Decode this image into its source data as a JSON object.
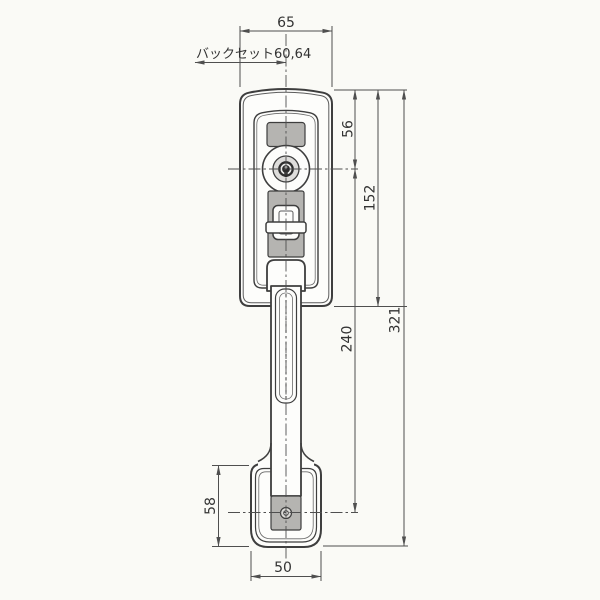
{
  "annotations": {
    "backset_label": "バックセット60,64",
    "dim_top_width": "65",
    "dim_cylinder_center": "56",
    "dim_plate_height": "152",
    "dim_handle_center_span": "240",
    "dim_overall_height": "321",
    "dim_bottom_plate_height": "58",
    "dim_bottom_plate_width": "50"
  },
  "colors": {
    "background": "#fafaf6",
    "paper": "#fdfdfb",
    "line": "#3e3e3e",
    "dim-line": "#4f4f4f",
    "text": "#333333",
    "metal-gray": "#b5b4b1",
    "cylinder-face": "#dedddb",
    "keyhole-dark": "#2e2e2e"
  }
}
